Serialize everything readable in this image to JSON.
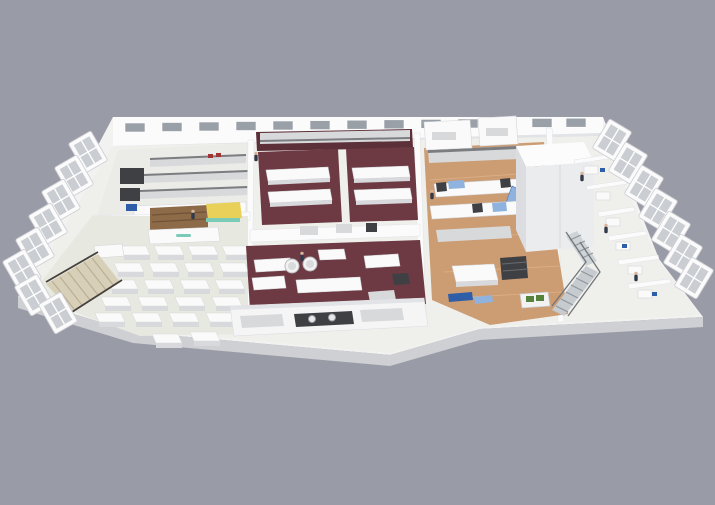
{
  "scene": {
    "description": "3D isometric cutaway rendering of a single-story commercial central-kitchen facility floor plan, viewed from above on a plain gray background; no legible text",
    "regions": [
      "storage-and-prep-rooms",
      "dining-hall-with-table-rows",
      "retail-kiosk-with-yellow-canopy",
      "hot-kitchen-upper-maroon-floor",
      "hot-kitchen-lower-maroon-floor",
      "front-serving-counter-line",
      "production-line-area-wood-floor",
      "cold-storage-room",
      "office-lab-wing",
      "left-staircase",
      "right-metal-staircase",
      "perimeter-window-panels"
    ]
  },
  "colors": {
    "bg": "#999ca6",
    "slab": "#f2f2f1",
    "slabFront": "#cfd0d4",
    "wall": "#fbfbfc",
    "wallShade": "#e2e3e6",
    "glass": "#9aa0a8",
    "floorBase": "#efefec",
    "floorRoom": "#ebebe7",
    "floorDining": "#e7e8e0",
    "floorKitchen": "#6d3a43",
    "floorKitchenDark": "#5c3038",
    "floorWood": "#cc9c72",
    "floorWoodLight": "#ddb188",
    "counter": "#f5f5f6",
    "equip": "#d8d9db",
    "equipDark": "#7c7d81",
    "steel": "#c6cbcf",
    "blue": "#2f5ea8",
    "lightBlue": "#8fb3de",
    "kioskYellow": "#e9d058",
    "kioskTeal": "#7ccab8",
    "kioskBrown": "#8d6b49",
    "stair": "#d8cfb8",
    "stairLine": "#b9ae93",
    "rail": "#46413c",
    "white": "#fafafa",
    "shade": "#d8d9dc",
    "dark": "#3f4043",
    "red": "#a33434",
    "green": "#55833d",
    "personDark": "#323a4a"
  }
}
